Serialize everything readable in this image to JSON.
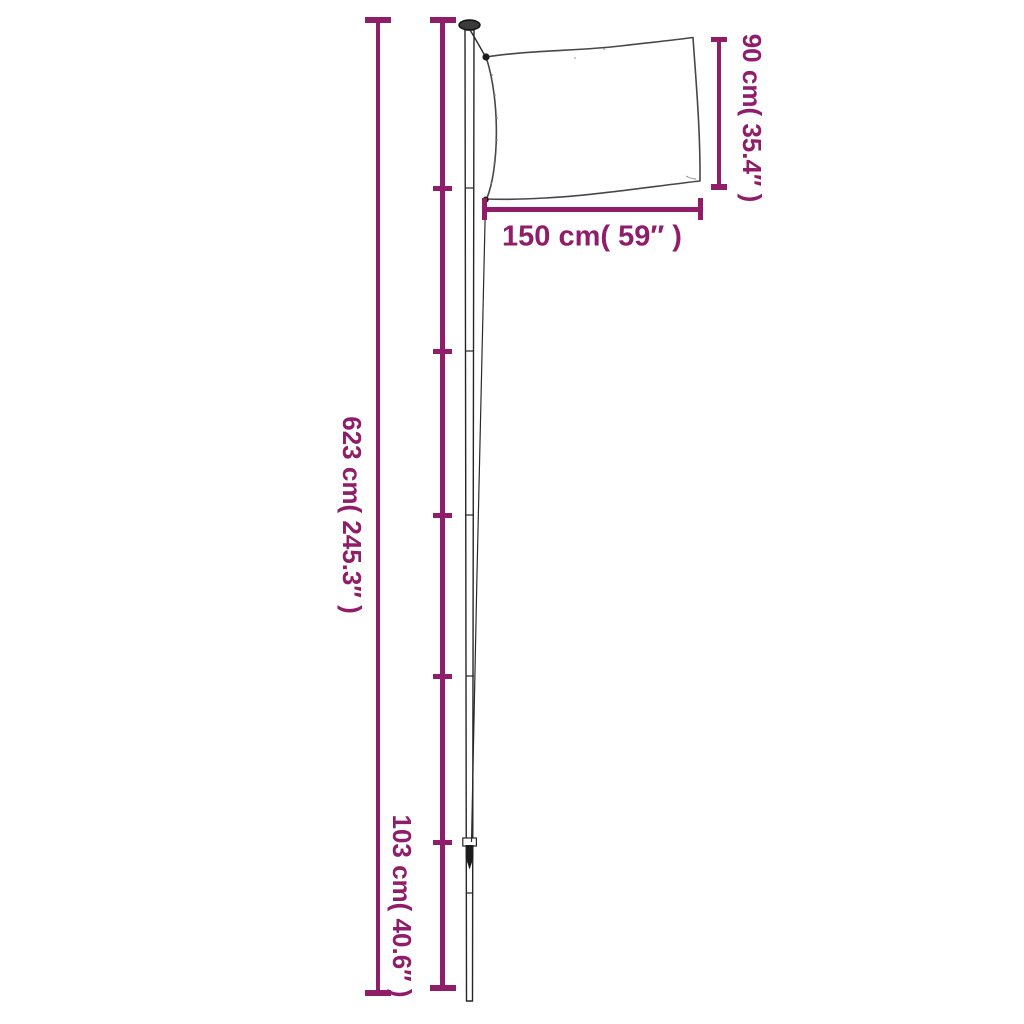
{
  "diagram": {
    "title": "Flagpole with flag — dimension diagram",
    "accent_color": "#8F1D6A",
    "background_color": "#FFFFFF",
    "labels": {
      "total_height": "623 cm( 245.3″ )",
      "bottom_section_height": "103 cm( 40.6″ )",
      "flag_height": "90 cm( 35.4″ )",
      "flag_width": "150 cm( 59″ )"
    },
    "values": {
      "total_height_cm": 623,
      "total_height_in": 245.3,
      "bottom_section_cm": 103,
      "bottom_section_in": 40.6,
      "flag_height_cm": 90,
      "flag_height_in": 35.4,
      "flag_width_cm": 150,
      "flag_width_in": 59
    },
    "pole": {
      "segment_joint_ticks": 5,
      "sections": 6
    }
  }
}
